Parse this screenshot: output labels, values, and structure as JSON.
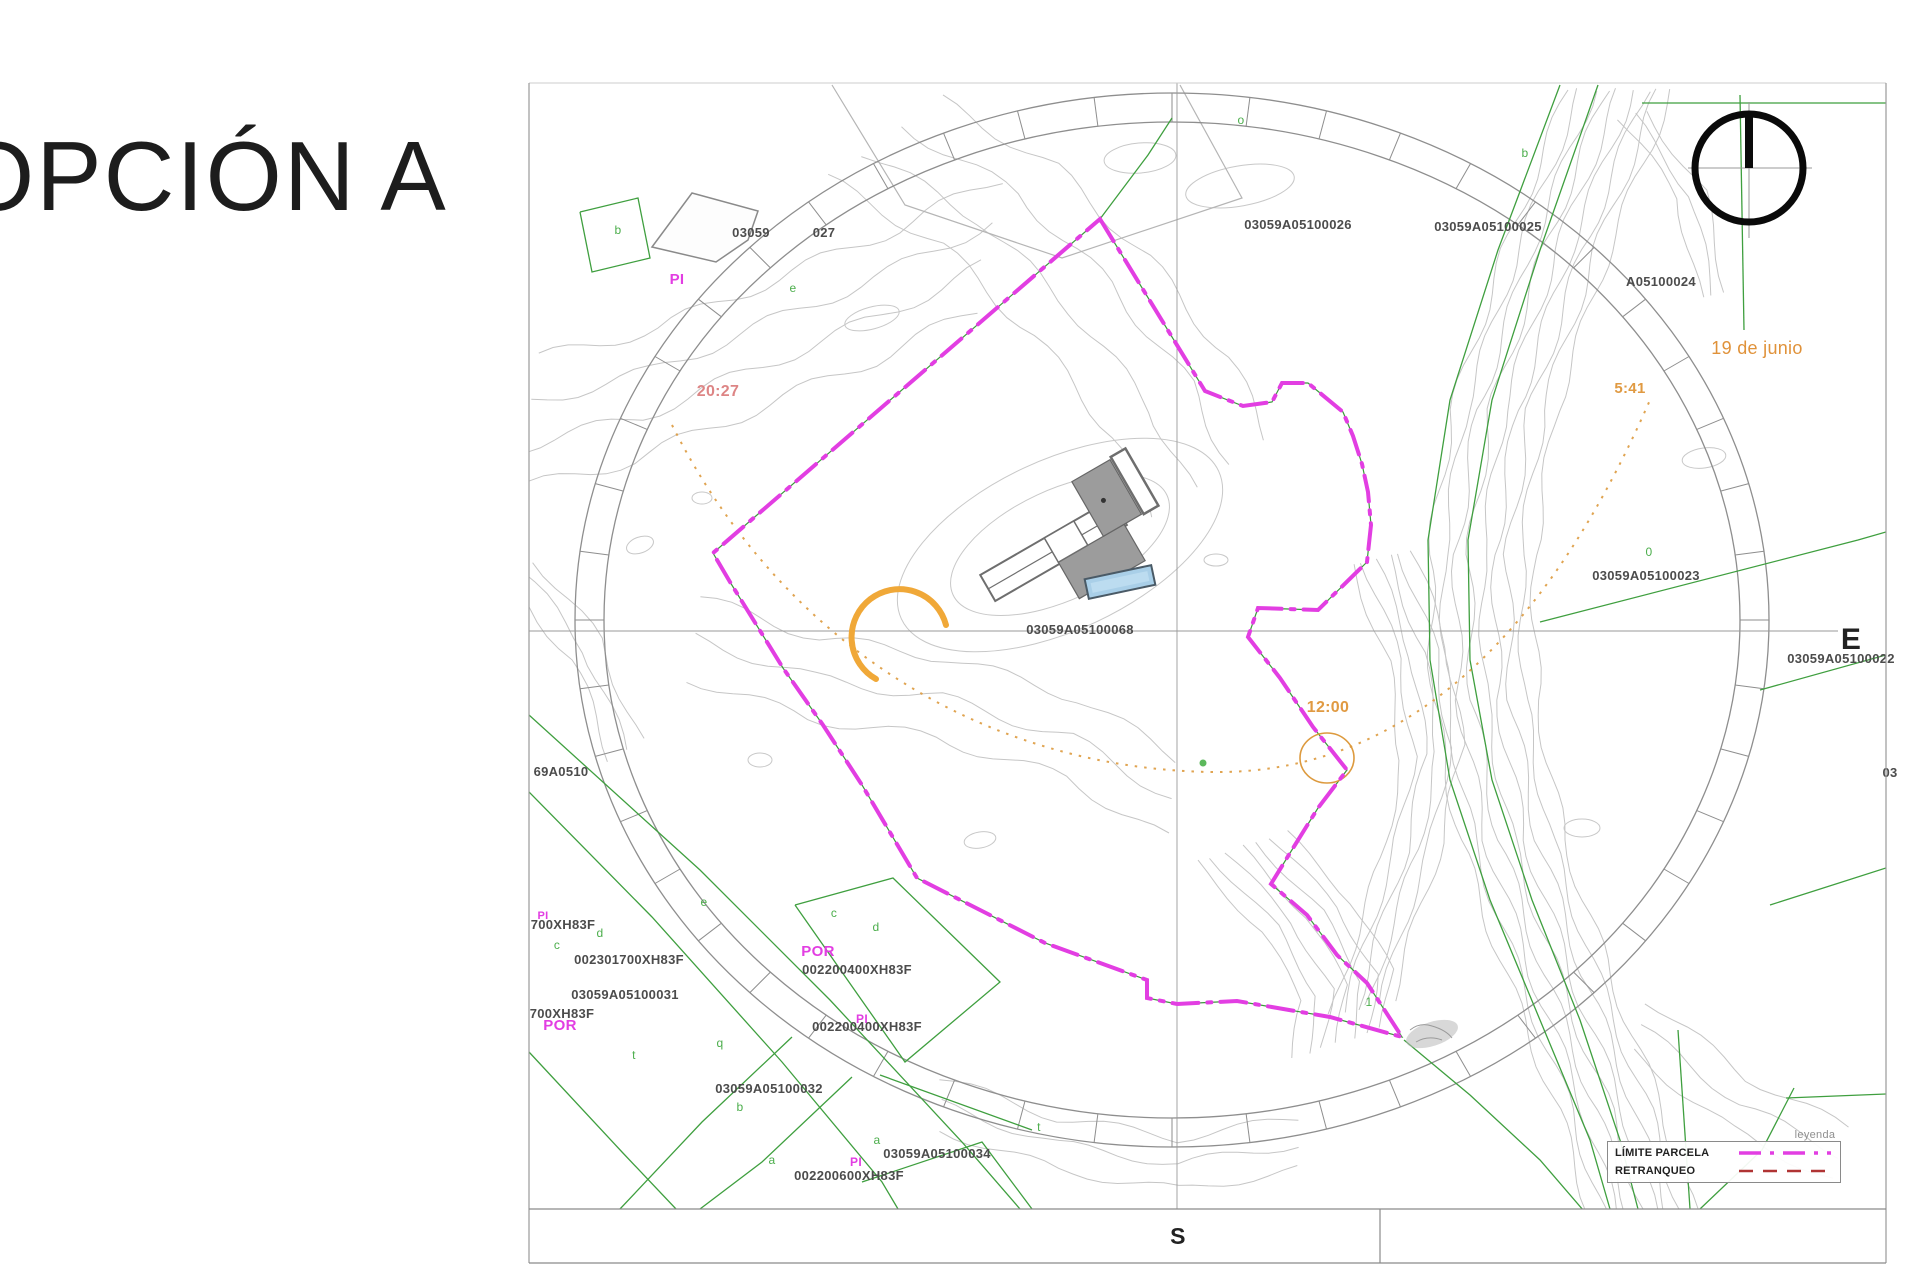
{
  "title": "OPCIÓN A",
  "map": {
    "legend": {
      "caption": "leyenda",
      "items": [
        {
          "label": "LÍMITE PARCELA",
          "line": "dash-dot",
          "color": "#e23ee2"
        },
        {
          "label": "RETRANQUEO",
          "line": "dashed",
          "color": "#b03434"
        }
      ]
    },
    "labels": [
      {
        "n": "parcel-ref",
        "t": "03059",
        "x": 751,
        "y": 237
      },
      {
        "n": "parcel-ref",
        "t": "027",
        "x": 824,
        "y": 237
      },
      {
        "n": "parcel-ref",
        "t": "03059A05100026",
        "x": 1298,
        "y": 229
      },
      {
        "n": "parcel-ref",
        "t": "03059A05100025",
        "x": 1488,
        "y": 231
      },
      {
        "n": "parcel-ref",
        "t": "A05100024",
        "x": 1661,
        "y": 286
      },
      {
        "n": "parcel-ref",
        "t": "03059A05100023",
        "x": 1646,
        "y": 580
      },
      {
        "n": "parcel-ref",
        "t": "03059A05100022",
        "x": 1841,
        "y": 663
      },
      {
        "n": "parcel-ref",
        "t": "03",
        "x": 1890,
        "y": 777
      },
      {
        "n": "parcel-ref",
        "t": "03059A05100068",
        "x": 1080,
        "y": 634
      },
      {
        "n": "parcel-ref",
        "t": "69A0510",
        "x": 561,
        "y": 776
      },
      {
        "n": "parcel-ref",
        "t": "700XH83F",
        "x": 563,
        "y": 929
      },
      {
        "n": "parcel-ref",
        "t": "002301700XH83F",
        "x": 629,
        "y": 964
      },
      {
        "n": "parcel-ref",
        "t": "03059A05100031",
        "x": 625,
        "y": 999
      },
      {
        "n": "parcel-ref",
        "t": "700XH83F",
        "x": 562,
        "y": 1018
      },
      {
        "n": "use-code",
        "t": "POR",
        "x": 560,
        "y": 1030,
        "c": "#e23ee2",
        "s": 15
      },
      {
        "n": "use-code",
        "t": "POR",
        "x": 818,
        "y": 956,
        "c": "#e23ee2",
        "s": 15
      },
      {
        "n": "parcel-ref",
        "t": "002200400XH83F",
        "x": 857,
        "y": 974
      },
      {
        "n": "use-code",
        "t": "PI",
        "x": 862,
        "y": 1023,
        "c": "#e23ee2",
        "s": 12
      },
      {
        "n": "parcel-ref",
        "t": "002200400XH83F",
        "x": 867,
        "y": 1031
      },
      {
        "n": "parcel-ref",
        "t": "03059A05100032",
        "x": 769,
        "y": 1093
      },
      {
        "n": "parcel-ref",
        "t": "03059A05100034",
        "x": 937,
        "y": 1158
      },
      {
        "n": "use-code",
        "t": "PI",
        "x": 856,
        "y": 1166,
        "c": "#e23ee2",
        "s": 12
      },
      {
        "n": "parcel-ref",
        "t": "002200600XH83F",
        "x": 849,
        "y": 1180
      },
      {
        "n": "use-code",
        "t": "PI",
        "x": 677,
        "y": 284,
        "c": "#e23ee2",
        "s": 15
      },
      {
        "n": "use-code",
        "t": "PI",
        "x": 543,
        "y": 919,
        "c": "#e23ee2",
        "s": 11
      },
      {
        "n": "legend-caption",
        "t": "leyenda",
        "x": 1815,
        "y": 1138,
        "c": "#8f8f8f",
        "s": 11,
        "w": 400
      },
      {
        "n": "sunset-time",
        "t": "20:27",
        "x": 718,
        "y": 396,
        "c": "#dd8585",
        "s": 16
      },
      {
        "n": "sunrise-time",
        "t": "5:41",
        "x": 1630,
        "y": 393,
        "c": "#e09a42",
        "s": 15
      },
      {
        "n": "noon-time",
        "t": "12:00",
        "x": 1328,
        "y": 712,
        "c": "#e09a42",
        "s": 16
      },
      {
        "n": "solstice-date",
        "t": "19 de junio",
        "x": 1757,
        "y": 354,
        "c": "#e0923a",
        "s": 18,
        "w": 400
      },
      {
        "n": "east-label",
        "t": "E",
        "x": 1851,
        "y": 649,
        "c": "#222222",
        "s": 30
      },
      {
        "n": "south-label",
        "t": "S",
        "x": 1178,
        "y": 1244,
        "c": "#222222",
        "s": 23
      },
      {
        "n": "subparcel-letter",
        "t": "b",
        "x": 618,
        "y": 234,
        "c": "#4cae4c",
        "s": 12,
        "w": 400
      },
      {
        "n": "subparcel-letter",
        "t": "e",
        "x": 793,
        "y": 292,
        "c": "#4cae4c",
        "s": 12,
        "w": 400
      },
      {
        "n": "subparcel-letter",
        "t": "o",
        "x": 1241,
        "y": 124,
        "c": "#4cae4c",
        "s": 12,
        "w": 400
      },
      {
        "n": "subparcel-letter",
        "t": "b",
        "x": 1525,
        "y": 157,
        "c": "#4cae4c",
        "s": 12,
        "w": 400
      },
      {
        "n": "subparcel-letter",
        "t": "0",
        "x": 1649,
        "y": 556,
        "c": "#4cae4c",
        "s": 12,
        "w": 400
      },
      {
        "n": "subparcel-letter",
        "t": "c",
        "x": 834,
        "y": 917,
        "c": "#4cae4c",
        "s": 12,
        "w": 400
      },
      {
        "n": "subparcel-letter",
        "t": "d",
        "x": 876,
        "y": 931,
        "c": "#4cae4c",
        "s": 12,
        "w": 400
      },
      {
        "n": "subparcel-letter",
        "t": "e",
        "x": 704,
        "y": 906,
        "c": "#4cae4c",
        "s": 12,
        "w": 400
      },
      {
        "n": "subparcel-letter",
        "t": "c",
        "x": 557,
        "y": 949,
        "c": "#4cae4c",
        "s": 12,
        "w": 400
      },
      {
        "n": "subparcel-letter",
        "t": "d",
        "x": 600,
        "y": 937,
        "c": "#4cae4c",
        "s": 12,
        "w": 400
      },
      {
        "n": "subparcel-letter",
        "t": "t",
        "x": 634,
        "y": 1059,
        "c": "#4cae4c",
        "s": 12,
        "w": 400
      },
      {
        "n": "subparcel-letter",
        "t": "q",
        "x": 720,
        "y": 1047,
        "c": "#4cae4c",
        "s": 12,
        "w": 400
      },
      {
        "n": "subparcel-letter",
        "t": "b",
        "x": 740,
        "y": 1111,
        "c": "#4cae4c",
        "s": 12,
        "w": 400
      },
      {
        "n": "subparcel-letter",
        "t": "a",
        "x": 772,
        "y": 1164,
        "c": "#4cae4c",
        "s": 12,
        "w": 400
      },
      {
        "n": "subparcel-letter",
        "t": "a",
        "x": 877,
        "y": 1144,
        "c": "#4cae4c",
        "s": 12,
        "w": 400
      },
      {
        "n": "subparcel-letter",
        "t": "t",
        "x": 1039,
        "y": 1131,
        "c": "#4cae4c",
        "s": 12,
        "w": 400
      },
      {
        "n": "subparcel-letter",
        "t": "1",
        "x": 1369,
        "y": 1006,
        "c": "#4cae4c",
        "s": 12,
        "w": 400
      }
    ]
  },
  "colors": {
    "parcel_boundary": "#e23ee2",
    "retranqueo": "#b03434",
    "sun_path": "#dd9a3e",
    "sun_arc": "#f0a838",
    "cadastral_green": "#3f9f3f",
    "contour_gray": "#c6c6c6",
    "pool_blue": "#a9cfe8"
  }
}
